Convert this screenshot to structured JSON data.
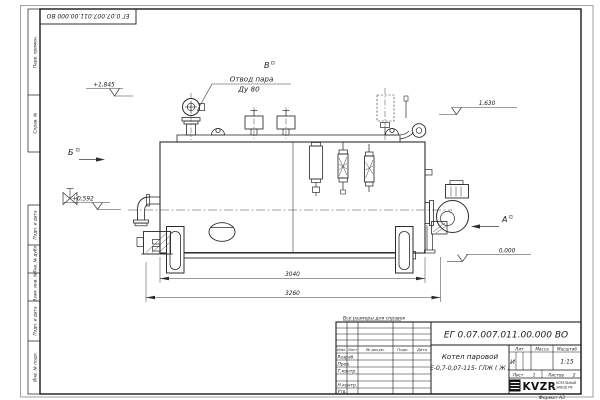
{
  "colors": {
    "line": "#2b2b2b",
    "frame": "#1a1a1a",
    "paper": "#ffffff"
  },
  "frame": {
    "stamp_rotated": "ЕГ 0.07.007.011.00.000  ВО",
    "format_label": "Формат А3",
    "left_column_top": [
      "Перв. примен.",
      "Справ. №"
    ],
    "left_column_bottom": [
      "Подп. и дата",
      "Инв. № дубл.",
      "Взам. инв. №",
      "Подп. и дата",
      "Инв. № подл."
    ]
  },
  "annotations": {
    "note": "Все размеры для справок",
    "callout": {
      "line1": "Отвод пара",
      "line2": "Ду 80"
    },
    "views": {
      "a": "А",
      "b": "Б",
      "v": "В"
    },
    "elevations": {
      "steam_valve": "+1,845",
      "boiler_top": "1,630",
      "feed_inlet": "+0,592",
      "floor": "0,000"
    },
    "dimensions": {
      "body_length": "3040",
      "overall_length": "3260"
    }
  },
  "title_block": {
    "designation": "ЕГ 0.07.007.011.00.000  ВО",
    "name_line1": "Котел паровой",
    "name_line2": "Е-0,7-0,07-115- ГЛЖ ( Ж )",
    "columns": {
      "izm": "Изм.",
      "list": "Лист",
      "doc": "№ докум.",
      "podp": "Подп.",
      "date": "Дата"
    },
    "roles": {
      "developer": "Разраб.",
      "checker": "Пров.",
      "tcontrol": "Т.контр.",
      "ncontrol": "Н.контр.",
      "approver": "Утв."
    },
    "lit": {
      "label": "Лит.",
      "value": "И"
    },
    "mass_label": "Масса",
    "scale": {
      "label": "Масштаб",
      "value": "1:15"
    },
    "sheet": {
      "label": "Лист",
      "value": "1"
    },
    "sheets": {
      "label": "Листов",
      "value": "2"
    },
    "company": {
      "logo_text": "KVZR",
      "tagline1": "КОТЕЛЬНЫЙ",
      "tagline2": "ЗАВОД РФ"
    }
  }
}
